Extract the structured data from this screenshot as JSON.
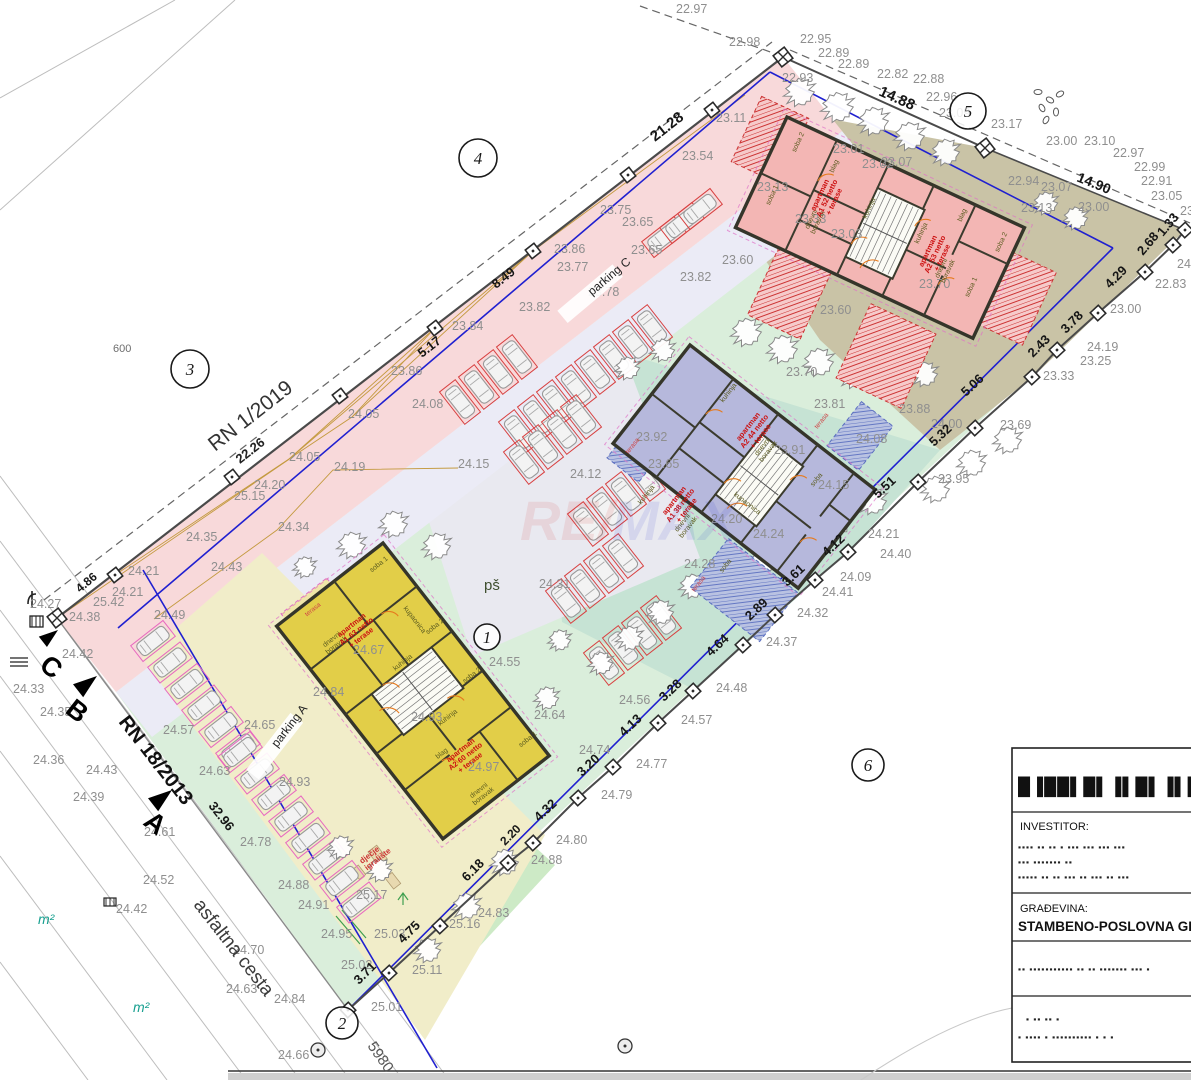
{
  "plan": {
    "special_labels": [
      {
        "t": "RN 1/2019",
        "x": 215,
        "y": 452,
        "r": -38,
        "s": 21,
        "c": "#333",
        "w": "normal"
      },
      {
        "t": "22.26",
        "x": 240,
        "y": 464,
        "r": -38,
        "s": 13,
        "c": "#222",
        "w": "bold"
      },
      {
        "t": "RN 18/2013",
        "x": 118,
        "y": 722,
        "r": 52,
        "s": 20,
        "c": "#111",
        "w": "bold"
      },
      {
        "t": "asfaltna cesta",
        "x": 193,
        "y": 905,
        "r": 52,
        "s": 19,
        "c": "#3c3c3c",
        "w": "normal"
      },
      {
        "t": "5980",
        "x": 367,
        "y": 1046,
        "r": 55,
        "s": 15,
        "c": "#555",
        "w": "normal"
      },
      {
        "t": "600",
        "x": 113,
        "y": 352,
        "r": 0,
        "s": 11,
        "c": "#6e6e6e",
        "w": "normal"
      },
      {
        "t": "pš",
        "x": 484,
        "y": 590,
        "r": 0,
        "s": 15,
        "c": "#3f4f2f",
        "w": "normal"
      },
      {
        "t": "m²",
        "x": 38,
        "y": 924,
        "r": 0,
        "s": 14,
        "c": "#18a090",
        "w": "normal"
      },
      {
        "t": "m²",
        "x": 133,
        "y": 1012,
        "r": 0,
        "s": 14,
        "c": "#18a090",
        "w": "normal"
      },
      {
        "t": "parking C",
        "x": 592,
        "y": 296,
        "r": -40,
        "s": 12,
        "c": "#222",
        "w": "normal",
        "chip": 1
      },
      {
        "t": "parking A",
        "x": 277,
        "y": 748,
        "r": -52,
        "s": 12,
        "c": "#222",
        "w": "normal",
        "chip": 1
      },
      {
        "t": "dječje\nigralište",
        "x": 362,
        "y": 864,
        "r": -38,
        "s": 8,
        "c": "#cc3333",
        "w": "bold"
      },
      {
        "t": "C",
        "x": 38,
        "y": 668,
        "r": 38,
        "s": 27,
        "c": "#000",
        "w": "bold"
      },
      {
        "t": "B",
        "x": 64,
        "y": 712,
        "r": 38,
        "s": 27,
        "c": "#000",
        "w": "bold"
      },
      {
        "t": "A",
        "x": 142,
        "y": 824,
        "r": 38,
        "s": 27,
        "c": "#000",
        "w": "bold"
      }
    ],
    "circled_numbers": [
      {
        "n": "1",
        "x": 487,
        "y": 637,
        "rr": 13
      },
      {
        "n": "2",
        "x": 342,
        "y": 1023,
        "rr": 16
      },
      {
        "n": "3",
        "x": 190,
        "y": 369,
        "rr": 19
      },
      {
        "n": "4",
        "x": 478,
        "y": 158,
        "rr": 19
      },
      {
        "n": "5",
        "x": 968,
        "y": 111,
        "rr": 18
      },
      {
        "n": "6",
        "x": 868,
        "y": 765,
        "rr": 16
      }
    ],
    "dimensions": [
      [
        655,
        142,
        "21.28",
        -38,
        15
      ],
      [
        878,
        95,
        "14.88",
        24,
        15
      ],
      [
        1076,
        181,
        "14.90",
        22,
        14
      ],
      [
        496,
        289,
        "8.49",
        -38,
        13
      ],
      [
        422,
        358,
        "5.17",
        -38,
        13
      ],
      [
        80,
        593,
        "4.86",
        -40,
        12
      ],
      [
        1163,
        237,
        "1.33",
        -50,
        13
      ],
      [
        1143,
        256,
        "2.68",
        -50,
        13
      ],
      [
        1110,
        289,
        "4.29",
        -45,
        13
      ],
      [
        1066,
        334,
        "3.78",
        -45,
        13
      ],
      [
        1033,
        358,
        "2.43",
        -45,
        13
      ],
      [
        966,
        397,
        "5.06",
        -43,
        13
      ],
      [
        934,
        447,
        "5.32",
        -43,
        13
      ],
      [
        878,
        499,
        "5.51",
        -43,
        13
      ],
      [
        827,
        557,
        "4.12",
        -43,
        13
      ],
      [
        787,
        587,
        "3.61",
        -43,
        13
      ],
      [
        750,
        621,
        "2.89",
        -43,
        13
      ],
      [
        711,
        657,
        "4.64",
        -43,
        13
      ],
      [
        664,
        702,
        "3.28",
        -43,
        13
      ],
      [
        624,
        737,
        "4.13",
        -43,
        13
      ],
      [
        582,
        777,
        "3.20",
        -43,
        13
      ],
      [
        539,
        822,
        "4.32",
        -43,
        13
      ],
      [
        505,
        846,
        "2.20",
        -45,
        12
      ],
      [
        467,
        882,
        "6.18",
        -45,
        13
      ],
      [
        403,
        944,
        "4.75",
        -45,
        13
      ],
      [
        359,
        985,
        "3.71",
        -45,
        13
      ],
      [
        208,
        806,
        "32.96",
        52,
        13
      ]
    ],
    "elevations": [
      [
        676,
        13,
        "22.97"
      ],
      [
        729,
        46,
        "22.98"
      ],
      [
        800,
        43,
        "22.95"
      ],
      [
        782,
        82,
        "22.93"
      ],
      [
        818,
        57,
        "22.89"
      ],
      [
        838,
        68,
        "22.89"
      ],
      [
        877,
        78,
        "22.82"
      ],
      [
        913,
        83,
        "22.88"
      ],
      [
        926,
        101,
        "22.96"
      ],
      [
        939,
        117,
        "23.09"
      ],
      [
        991,
        128,
        "23.17"
      ],
      [
        1046,
        145,
        "23.00"
      ],
      [
        1084,
        145,
        "23.10"
      ],
      [
        1113,
        157,
        "22.97"
      ],
      [
        1134,
        171,
        "22.99"
      ],
      [
        1141,
        185,
        "22.91"
      ],
      [
        1151,
        200,
        "23.05"
      ],
      [
        1008,
        185,
        "22.94"
      ],
      [
        1041,
        191,
        "23.07"
      ],
      [
        1021,
        212,
        "23.13"
      ],
      [
        1078,
        211,
        "23.00"
      ],
      [
        1180,
        215,
        "23.17"
      ],
      [
        862,
        168,
        "23.02"
      ],
      [
        716,
        122,
        "23.11"
      ],
      [
        833,
        153,
        "23.01"
      ],
      [
        881,
        166,
        "23.07"
      ],
      [
        757,
        191,
        "23.13"
      ],
      [
        795,
        223,
        "23.33"
      ],
      [
        831,
        238,
        "23.03"
      ],
      [
        722,
        264,
        "23.60"
      ],
      [
        919,
        288,
        "23.70"
      ],
      [
        820,
        314,
        "23.60"
      ],
      [
        682,
        160,
        "23.54"
      ],
      [
        600,
        214,
        "23.75"
      ],
      [
        622,
        226,
        "23.65"
      ],
      [
        631,
        254,
        "23.65"
      ],
      [
        557,
        271,
        "23.77"
      ],
      [
        588,
        296,
        "23.78"
      ],
      [
        519,
        311,
        "23.82"
      ],
      [
        680,
        281,
        "23.82"
      ],
      [
        452,
        330,
        "23.84"
      ],
      [
        554,
        253,
        "23.86"
      ],
      [
        391,
        375,
        "23.86"
      ],
      [
        348,
        418,
        "24.05"
      ],
      [
        289,
        461,
        "24.05"
      ],
      [
        334,
        471,
        "24.19"
      ],
      [
        254,
        489,
        "24.20"
      ],
      [
        234,
        500,
        "25.15"
      ],
      [
        278,
        531,
        "24.34"
      ],
      [
        186,
        541,
        "24.35"
      ],
      [
        211,
        571,
        "24.43"
      ],
      [
        154,
        619,
        "24.49"
      ],
      [
        458,
        468,
        "24.15"
      ],
      [
        570,
        478,
        "24.12"
      ],
      [
        412,
        408,
        "24.08"
      ],
      [
        539,
        588,
        "24.31"
      ],
      [
        636,
        441,
        "23.92"
      ],
      [
        648,
        468,
        "23.65"
      ],
      [
        786,
        376,
        "23.70"
      ],
      [
        814,
        408,
        "23.81"
      ],
      [
        774,
        454,
        "23.91"
      ],
      [
        899,
        413,
        "23.88"
      ],
      [
        931,
        428,
        "24.00"
      ],
      [
        856,
        443,
        "24.08"
      ],
      [
        818,
        489,
        "24.15"
      ],
      [
        711,
        523,
        "24.20"
      ],
      [
        753,
        538,
        "24.24"
      ],
      [
        684,
        568,
        "24.28"
      ],
      [
        489,
        666,
        "24.55"
      ],
      [
        353,
        654,
        "24.67"
      ],
      [
        313,
        696,
        "24.84"
      ],
      [
        411,
        721,
        "24.93"
      ],
      [
        468,
        771,
        "24.97"
      ],
      [
        244,
        729,
        "24.65"
      ],
      [
        199,
        775,
        "24.63"
      ],
      [
        163,
        734,
        "24.57"
      ],
      [
        279,
        786,
        "24.93"
      ],
      [
        240,
        846,
        "24.78"
      ],
      [
        30,
        608,
        "24.27"
      ],
      [
        128,
        575,
        "24.21"
      ],
      [
        112,
        596,
        "24.21"
      ],
      [
        93,
        606,
        "25.42"
      ],
      [
        69,
        621,
        "24.38"
      ],
      [
        62,
        658,
        "24.42"
      ],
      [
        13,
        693,
        "24.33"
      ],
      [
        40,
        716,
        "24.35"
      ],
      [
        33,
        764,
        "24.36"
      ],
      [
        86,
        774,
        "24.43"
      ],
      [
        73,
        801,
        "24.39"
      ],
      [
        144,
        836,
        "24.61"
      ],
      [
        143,
        884,
        "24.52"
      ],
      [
        116,
        913,
        "24.42"
      ],
      [
        233,
        954,
        "24.70"
      ],
      [
        226,
        993,
        "24.63"
      ],
      [
        274,
        1003,
        "24.84"
      ],
      [
        278,
        1059,
        "24.66"
      ],
      [
        278,
        889,
        "24.88"
      ],
      [
        298,
        909,
        "24.91"
      ],
      [
        321,
        938,
        "24.95"
      ],
      [
        341,
        969,
        "25.02"
      ],
      [
        374,
        938,
        "25.03"
      ],
      [
        356,
        899,
        "25.17"
      ],
      [
        579,
        754,
        "24.74"
      ],
      [
        619,
        704,
        "24.56"
      ],
      [
        534,
        719,
        "24.64"
      ],
      [
        1177,
        268,
        "24.00"
      ],
      [
        1155,
        288,
        "22.83"
      ],
      [
        1110,
        313,
        "23.00"
      ],
      [
        1087,
        351,
        "24.19"
      ],
      [
        1080,
        365,
        "23.25"
      ],
      [
        1043,
        380,
        "23.33"
      ],
      [
        1000,
        429,
        "23.69"
      ],
      [
        938,
        483,
        "23.95"
      ],
      [
        868,
        538,
        "24.21"
      ],
      [
        880,
        558,
        "24.40"
      ],
      [
        840,
        581,
        "24.09"
      ],
      [
        822,
        596,
        "24.41"
      ],
      [
        797,
        617,
        "24.32"
      ],
      [
        766,
        646,
        "24.37"
      ],
      [
        716,
        692,
        "24.48"
      ],
      [
        681,
        724,
        "24.57"
      ],
      [
        636,
        768,
        "24.77"
      ],
      [
        601,
        799,
        "24.79"
      ],
      [
        556,
        844,
        "24.80"
      ],
      [
        531,
        864,
        "24.88"
      ],
      [
        478,
        917,
        "24.83"
      ],
      [
        449,
        928,
        "25.16"
      ],
      [
        412,
        974,
        "25.11"
      ],
      [
        371,
        1011,
        "25.01"
      ]
    ],
    "rooms": [
      {
        "t": "soba 1",
        "x": 380,
        "y": 566,
        "r": -38
      },
      {
        "t": "kupaonica",
        "x": 413,
        "y": 621,
        "r": 52
      },
      {
        "t": "soba 2",
        "x": 436,
        "y": 628,
        "r": -38
      },
      {
        "t": "kuhinja",
        "x": 404,
        "y": 664,
        "r": -38
      },
      {
        "t": "soba 2",
        "x": 473,
        "y": 677,
        "r": -38
      },
      {
        "t": "kuhinja",
        "x": 449,
        "y": 719,
        "r": -38
      },
      {
        "t": "blag",
        "x": 443,
        "y": 755,
        "r": -38
      },
      {
        "t": "soba 1",
        "x": 529,
        "y": 741,
        "r": -38
      },
      {
        "t": "dnevni\nboravak",
        "x": 333,
        "y": 641,
        "r": -38
      },
      {
        "t": "dnevni\nboravak",
        "x": 480,
        "y": 792,
        "r": -38
      },
      {
        "t": "terasa",
        "x": 314,
        "y": 611,
        "r": -38,
        "c": "red"
      },
      {
        "t": "soba 2",
        "x": 800,
        "y": 143,
        "r": -65
      },
      {
        "t": "soba 1",
        "x": 774,
        "y": 196,
        "r": -65
      },
      {
        "t": "blag",
        "x": 836,
        "y": 167,
        "r": -65
      },
      {
        "t": "kuhinja",
        "x": 871,
        "y": 209,
        "r": -65
      },
      {
        "t": "kuhinja",
        "x": 923,
        "y": 234,
        "r": -65
      },
      {
        "t": "soba 2",
        "x": 1003,
        "y": 243,
        "r": -65
      },
      {
        "t": "soba 1",
        "x": 973,
        "y": 288,
        "r": -65
      },
      {
        "t": "blag",
        "x": 964,
        "y": 216,
        "r": -65
      },
      {
        "t": "dnevni\nboravak",
        "x": 813,
        "y": 220,
        "r": -65
      },
      {
        "t": "dnevni\nboravak",
        "x": 943,
        "y": 269,
        "r": -65
      },
      {
        "t": "kuhinja",
        "x": 730,
        "y": 394,
        "r": -52
      },
      {
        "t": "dnevni\nboravak",
        "x": 764,
        "y": 448,
        "r": -52
      },
      {
        "t": "soba",
        "x": 818,
        "y": 481,
        "r": -52
      },
      {
        "t": "kuhinja",
        "x": 648,
        "y": 496,
        "r": -52
      },
      {
        "t": "dnevni\nboravak",
        "x": 684,
        "y": 524,
        "r": -52
      },
      {
        "t": "soba",
        "x": 727,
        "y": 567,
        "r": -52
      },
      {
        "t": "kupaonica",
        "x": 746,
        "y": 505,
        "r": 38
      },
      {
        "t": "terasa",
        "x": 634,
        "y": 447,
        "r": -52,
        "c": "red"
      },
      {
        "t": "terasa",
        "x": 823,
        "y": 422,
        "r": -52,
        "c": "red"
      },
      {
        "t": "terasa",
        "x": 700,
        "y": 585,
        "r": -52,
        "c": "red"
      }
    ],
    "apartments": [
      {
        "t": "apartman\nA1 63 netto\n+ terase",
        "x": 353,
        "y": 627,
        "r": -38
      },
      {
        "t": "apartman\nA2 60 netto\n+ terase",
        "x": 462,
        "y": 752,
        "r": -38
      },
      {
        "t": "apartman\nA1 52 netto\n+ terase",
        "x": 822,
        "y": 196,
        "r": -65
      },
      {
        "t": "apartman\nA2 53 netto\n+ terase",
        "x": 930,
        "y": 252,
        "r": -65
      },
      {
        "t": "apartman\nA2 44 netto\n+ terase",
        "x": 750,
        "y": 428,
        "r": -52
      },
      {
        "t": "apartman\nA1 38 netto\n+ terase",
        "x": 676,
        "y": 502,
        "r": -52
      }
    ],
    "watermark": {
      "left": "RE/",
      "right": "MAX",
      "left_color": "#d42222",
      "right_color": "#2233cc"
    }
  },
  "title_block": {
    "logo": "█▐██▌█▌▐▌█▌▐▌██▌▐█",
    "investor_label": "INVESTITOR:",
    "investor_line1": "▪▪▪▪ ▪▪ ▪▪ ▪ ▪▪▪ ▪▪▪ ▪▪▪ ▪▪▪",
    "investor_line2": "▪▪▪ ▪▪▪▪▪▪▪ ▪▪",
    "investor_line3": "▪▪▪▪▪ ▪▪ ▪▪ ▪▪▪ ▪▪ ▪▪▪ ▪▪ ▪▪▪",
    "gradevina_label": "GRAĐEVINA:",
    "gradevina_value": "STAMBENO-POSLOVNA GRAĐ",
    "row4": "▪▪ ▪▪▪▪▪▪▪▪▪▪▪ ▪▪ ▪▪ ▪▪▪▪▪▪▪ ▪▪▪ ▪",
    "row5a": "▪ ▪▪ ▪▪ ▪",
    "row5b": "▪ ▪▪▪▪ ▪ ▪▪▪▪▪▪▪▪▪▪ ▪ ▪ ▪"
  }
}
